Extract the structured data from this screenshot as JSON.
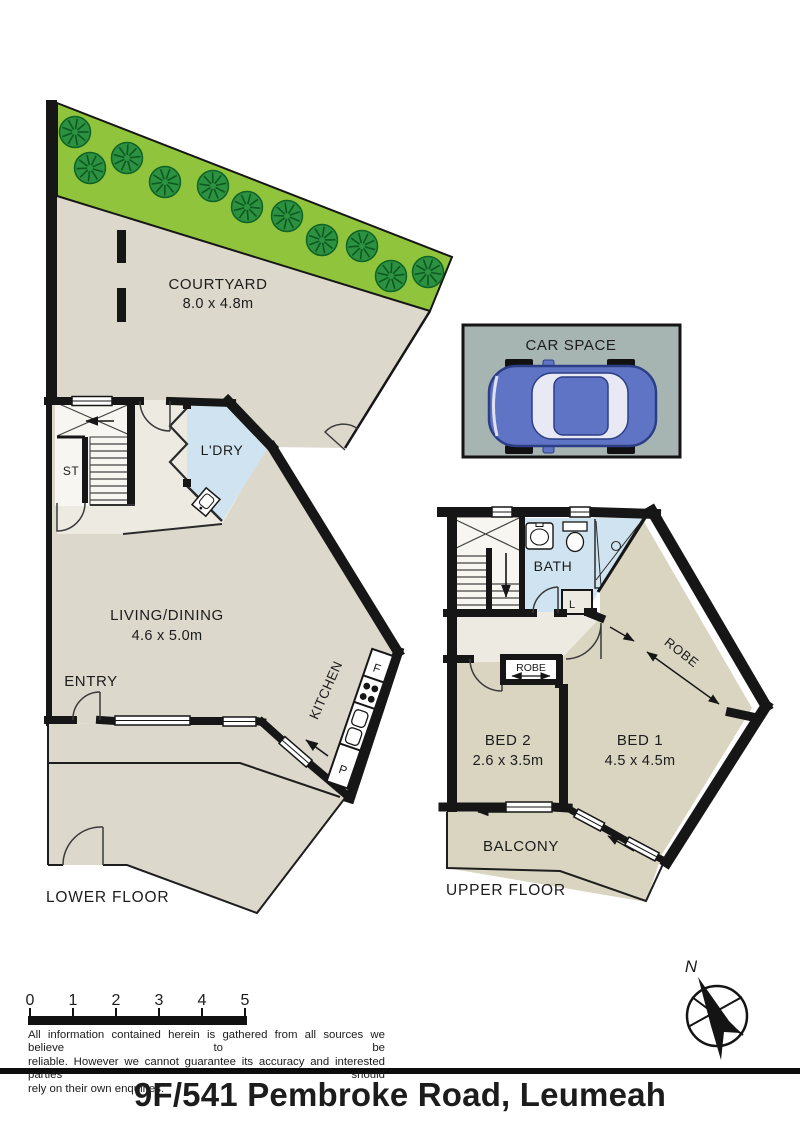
{
  "title": "9F/541 Pembroke Road, Leumeah",
  "courtyard": {
    "label": "COURTYARD",
    "dims": "8.0 x 4.8m",
    "trees": [
      [
        75,
        132
      ],
      [
        90,
        168
      ],
      [
        127,
        158
      ],
      [
        165,
        182
      ],
      [
        213,
        186
      ],
      [
        247,
        207
      ],
      [
        287,
        216
      ],
      [
        322,
        240
      ],
      [
        362,
        246
      ],
      [
        391,
        276
      ],
      [
        428,
        272
      ]
    ]
  },
  "car_space": {
    "label": "CAR SPACE"
  },
  "lower_floor": {
    "floor_label": "LOWER FLOOR",
    "living": {
      "label": "LIVING/DINING",
      "dims": "4.6 x 5.0m"
    },
    "entry_label": "ENTRY",
    "laundry_label": "L'DRY",
    "store_label": "ST",
    "kitchen": {
      "label": "KITCHEN",
      "fridge": "F",
      "pantry": "P"
    }
  },
  "upper_floor": {
    "floor_label": "UPPER FLOOR",
    "bath_label": "BATH",
    "linen_label": "L",
    "robe_corridor_label": "ROBE",
    "robe_bed2_label": "ROBE",
    "bed1": {
      "label": "BED 1",
      "dims": "4.5 x 4.5m"
    },
    "bed2": {
      "label": "BED 2",
      "dims": "2.6 x 3.5m"
    },
    "balcony_label": "BALCONY"
  },
  "scale_bar": {
    "labels": [
      "0",
      "1",
      "2",
      "3",
      "4",
      "5"
    ]
  },
  "compass": {
    "north_label": "N"
  },
  "disclaimer": {
    "line1": "All information contained herein is gathered from all sources we believe to be",
    "line2": "reliable. However we cannot guarantee its accuracy and interested parties should",
    "line3": "rely on their own enquiries."
  },
  "colors": {
    "wall": "#161616",
    "floor": "#dcd8cc",
    "hall": "#edeae1",
    "bedroom": "#d9d5c1",
    "wet_area": "#cfe4f0",
    "lawn": "#8fc43c",
    "tree": "#2c9140",
    "car_space_bg": "#a6b5b2",
    "car_body": "#5f74c4"
  }
}
